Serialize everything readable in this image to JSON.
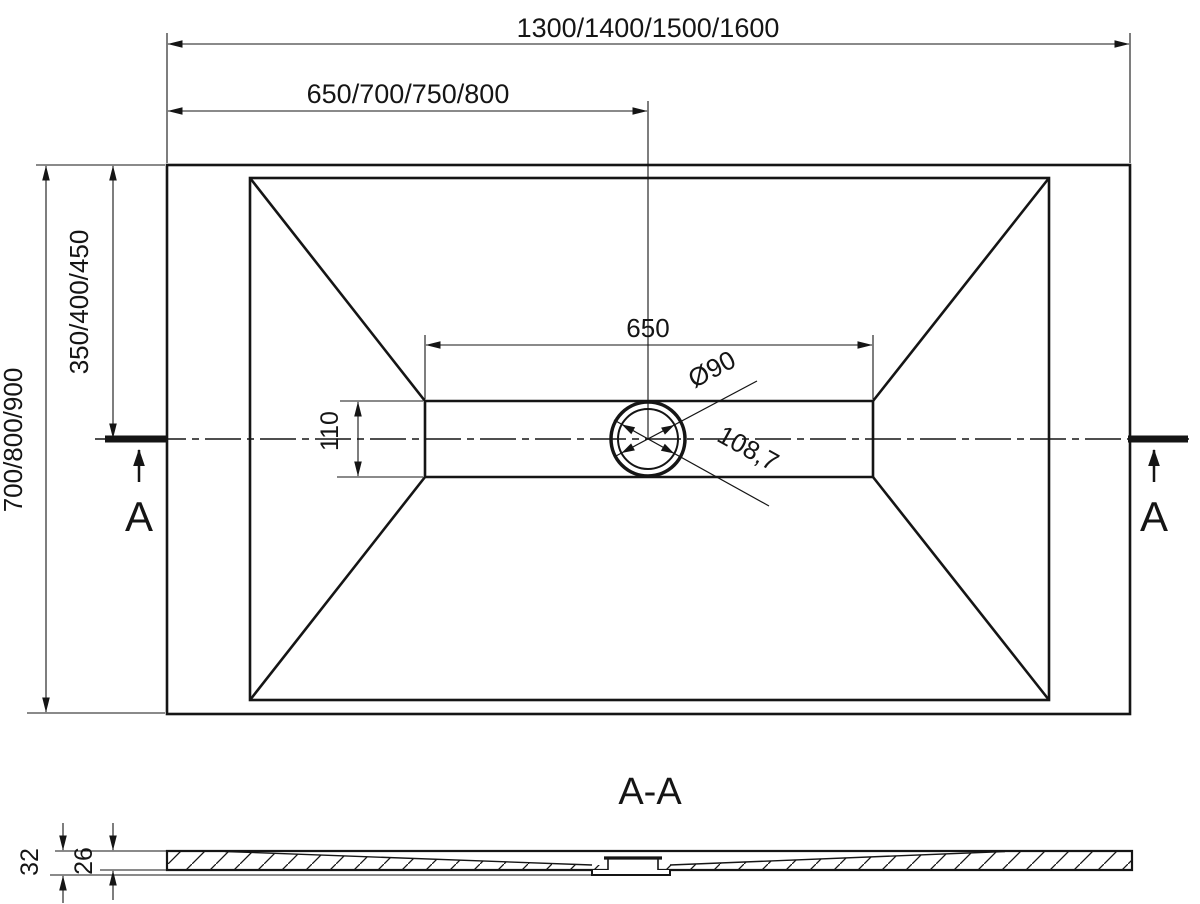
{
  "drawing": {
    "background": "#ffffff",
    "line_color": "#151515",
    "top_view": {
      "overall_width": "1300/1400/1500/1600",
      "width_to_drain_center": "650/700/750/800",
      "overall_depth": "700/800/900",
      "depth_to_drain_center": "350/400/450",
      "channel_length": "650",
      "channel_width": "110",
      "drain_diameter": "Ø90",
      "drain_diagonal": "108,7",
      "section_marker_left": "A",
      "section_marker_right": "A"
    },
    "section_view": {
      "title": "A-A",
      "total_height": "32",
      "base_thickness": "26"
    }
  }
}
